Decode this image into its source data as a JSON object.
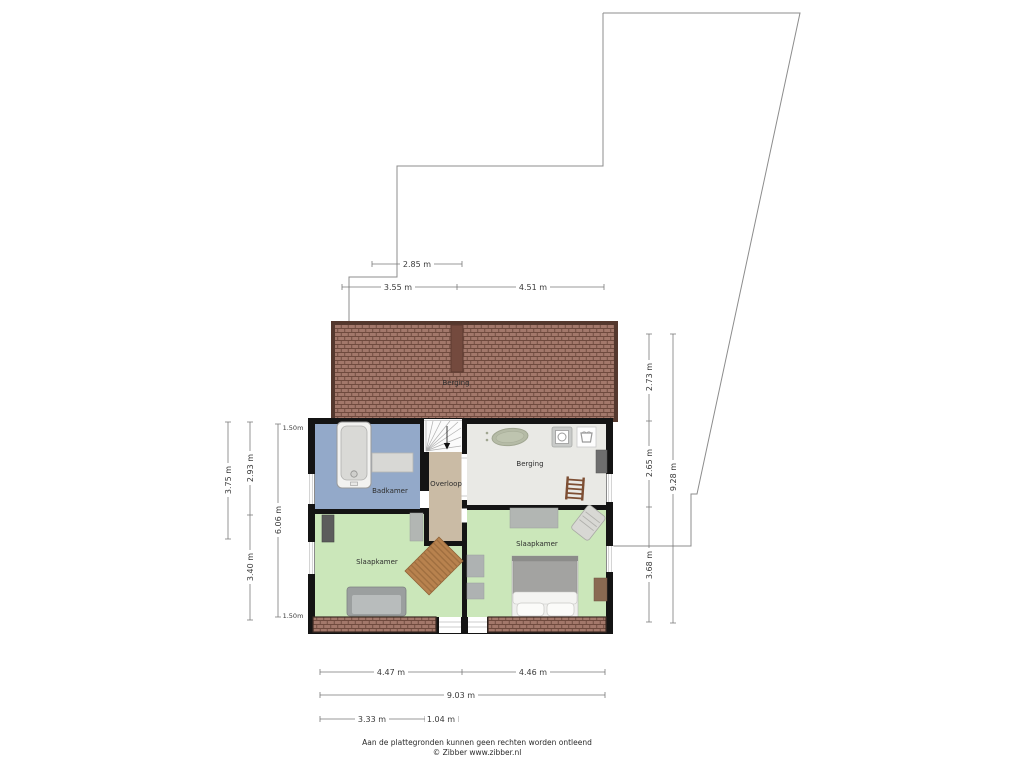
{
  "plan": {
    "roof_label": "Berging",
    "rooms": {
      "badkamer": "Badkamer",
      "overloop": "Overloop",
      "berging": "Berging",
      "slaapkamer_left": "Slaapkamer",
      "slaapkamer_right": "Slaapkamer"
    }
  },
  "dims": {
    "top_285": "2.85 m",
    "top_355": "3.55 m",
    "top_451": "4.51 m",
    "left_375": "3.75 m",
    "left_293": "2.93 m",
    "left_340": "3.40 m",
    "left_606": "6.06 m",
    "marker_top": "1.50m",
    "marker_bottom": "1.50m",
    "right_273": "2.73 m",
    "right_265": "2.65 m",
    "right_928": "9.28 m",
    "right_368": "3.68 m",
    "bottom_447": "4.47 m",
    "bottom_446": "4.46 m",
    "bottom_903": "9.03 m",
    "bottom_333": "3.33 m",
    "bottom_104": "1.04 m"
  },
  "footer": {
    "line1": "Aan de plattegronden kunnen geen rechten worden ontleend",
    "line2": "© Zibber www.zibber.nl"
  },
  "icons": {
    "bathtub": "bathtub-icon",
    "sink_counter": "counter-icon",
    "oval_bath": "oval-bath-icon",
    "washing_machine": "washing-machine-icon",
    "laundry_basket": "laundry-basket-icon",
    "ladder": "ladder-icon",
    "stairs": "stairs-icon",
    "rug": "rug-icon",
    "sofa": "sofa-icon",
    "bed": "bed-icon",
    "closet": "closet-icon",
    "lounge_chair": "lounge-chair-icon"
  },
  "colors": {
    "wall": "#141414",
    "roof_base": "#a3786b",
    "roof_line": "#6f4a3e",
    "roof_border": "#54382e",
    "badkamer": "#93a9c9",
    "overloop": "#cabba5",
    "berging": "#e9e9e5",
    "slaapkamer": "#cbe7ba",
    "boundary": "#8c8c8c",
    "dimension": "#7a7a7a"
  }
}
